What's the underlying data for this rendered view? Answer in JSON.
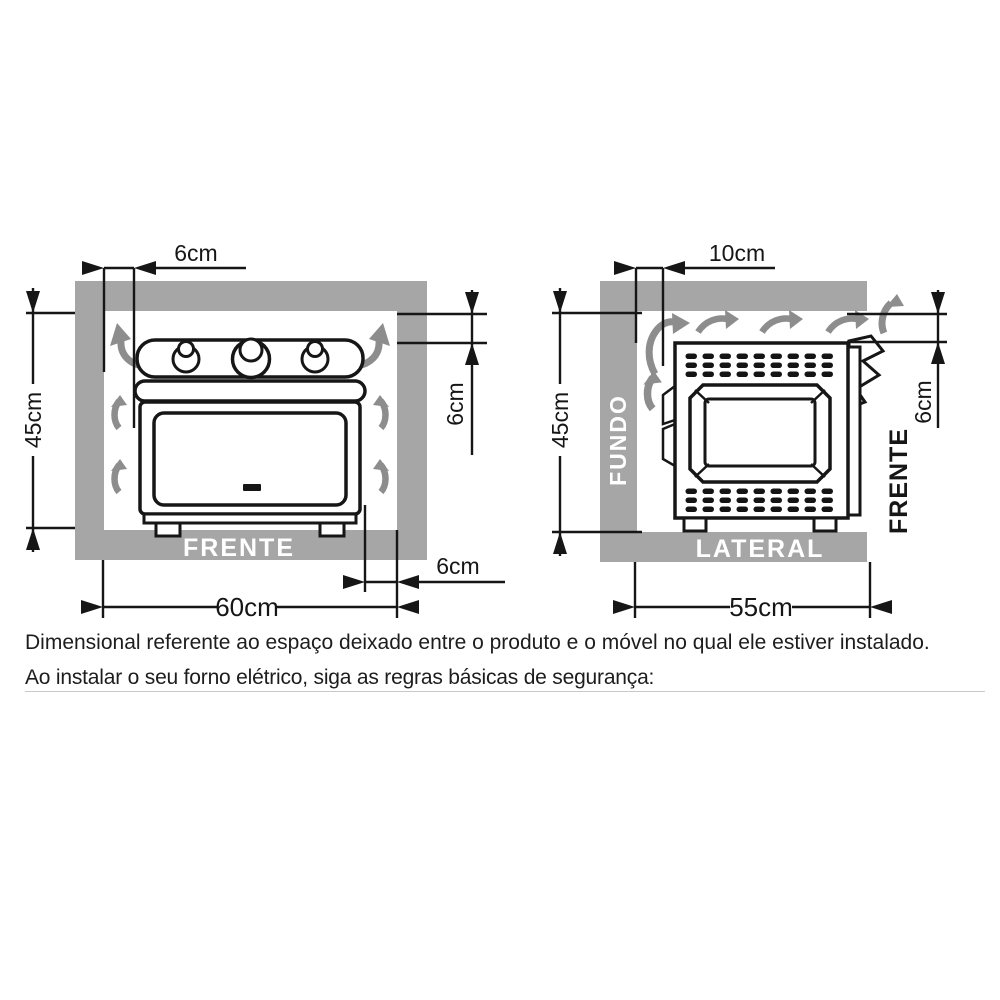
{
  "front_view": {
    "label": "FRENTE",
    "top_gap": "6cm",
    "height": "45cm",
    "side_gap": "6cm",
    "bottom_side_gap": "6cm",
    "width": "60cm"
  },
  "side_view": {
    "back_label": "FUNDO",
    "bottom_label": "LATERAL",
    "front_label": "FRENTE",
    "top_gap": "10cm",
    "height": "45cm",
    "front_gap": "6cm",
    "width": "55cm"
  },
  "notes": {
    "line1": "Dimensional referente ao espaço deixado entre o produto e o móvel no qual ele estiver instalado.",
    "line2": "Ao instalar o seu forno elétrico, siga as regras básicas de segurança:"
  },
  "colors": {
    "frame_gray": "#a6a6a6",
    "arrow_gray": "#8d8d8d",
    "ink": "#161616",
    "divider_gray": "#c8c8c8"
  }
}
